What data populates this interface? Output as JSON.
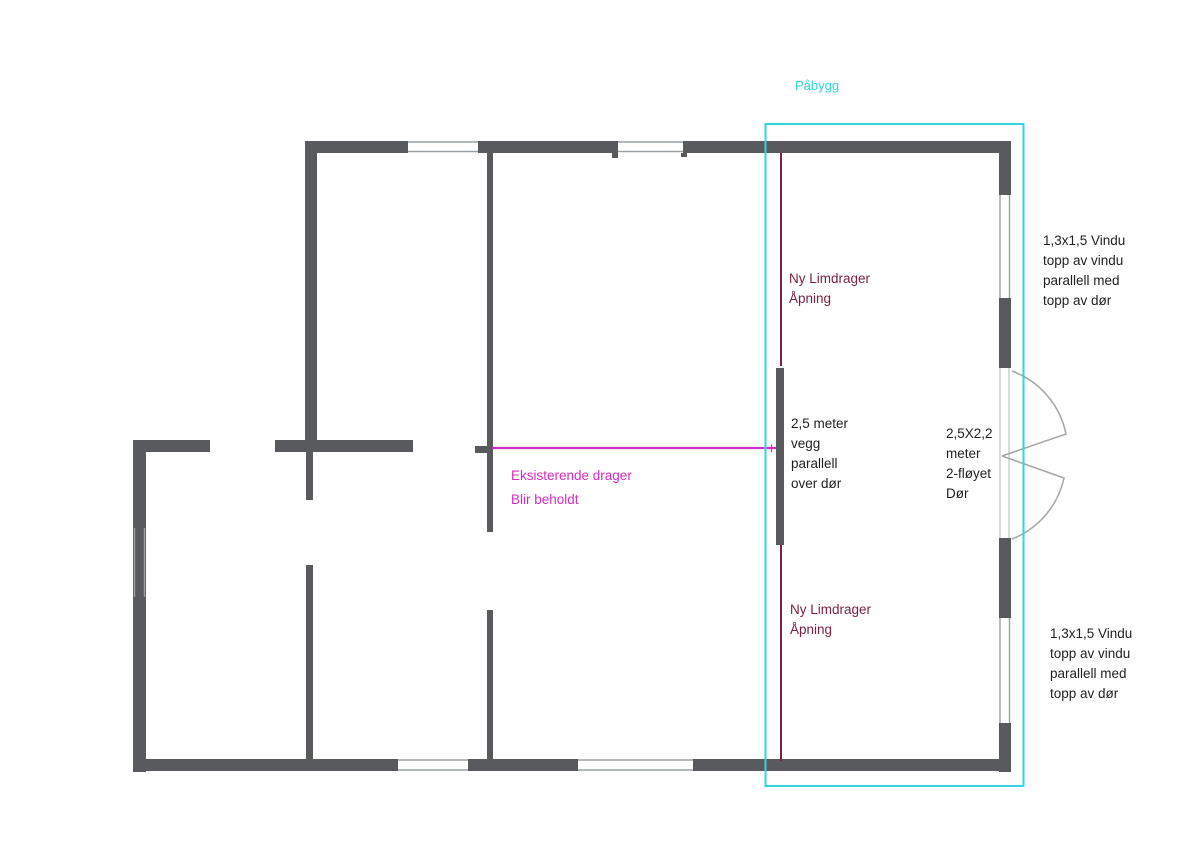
{
  "document": {
    "type": "floor-plan-sketch",
    "language": "Norwegian"
  },
  "colors": {
    "wall": "#595a5e",
    "window_line": "#9aa0a3",
    "door_frame_line": "#c4c7ca",
    "door_arc": "#a8a8a8",
    "extension_box": "#2ed7e0",
    "existing_beam_magenta": "#d82cc6",
    "new_beam_maroon": "#7d2145",
    "text": "#1f1f1f",
    "background": "#ffffff"
  },
  "labels": {
    "paabygg": "Påbygg",
    "ny_limdrager_top": "Ny Limdrager\nÅpning",
    "vegg_note": "2,5 meter\nvegg\nparallell\nover dør",
    "dor_note": "2,5X2,2\nmeter\n2-fløyet\nDør",
    "eksisterende_line1": "Eksisterende drager",
    "eksisterende_line2": "Blir beholdt",
    "ny_limdrager_bottom": "Ny Limdrager\nÅpning",
    "vindu_note_top": "1,3x1,5 Vindu\ntopp av vindu\nparallell med\ntopp av dør",
    "vindu_note_bottom": "1,3x1,5 Vindu\ntopp av vindu\nparallell med\ntopp av dør"
  }
}
